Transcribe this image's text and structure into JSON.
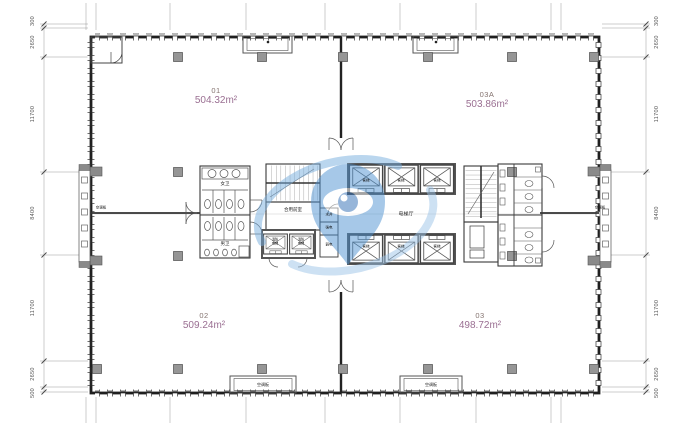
{
  "drawing": {
    "rooms": [
      {
        "id": "01",
        "area": "504.32m²"
      },
      {
        "id": "03A",
        "area": "503.86m²"
      },
      {
        "id": "02",
        "area": "509.24m²"
      },
      {
        "id": "03",
        "area": "498.72m²"
      }
    ],
    "core": {
      "womens_toilet": "女卫",
      "mens_toilet": "男卫",
      "shared_lobby": "合用前室",
      "elevator_hall": "电梯厅",
      "fire_elevator": "消防电梯",
      "passenger_elevator": "客梯",
      "shafts": [
        "水井",
        "强电",
        "弱电"
      ],
      "ac_panel": "空调板"
    },
    "dimensions": {
      "left": [
        "300",
        "2650",
        "11700",
        "8400",
        "11700",
        "2650",
        "500"
      ],
      "right": [
        "300",
        "2650",
        "11700",
        "8400",
        "11700",
        "2650",
        "500"
      ]
    },
    "colors": {
      "room_id_text": "#857470",
      "room_area_text": "#9a6f92",
      "watermark_blue": "#4f93d2"
    }
  }
}
